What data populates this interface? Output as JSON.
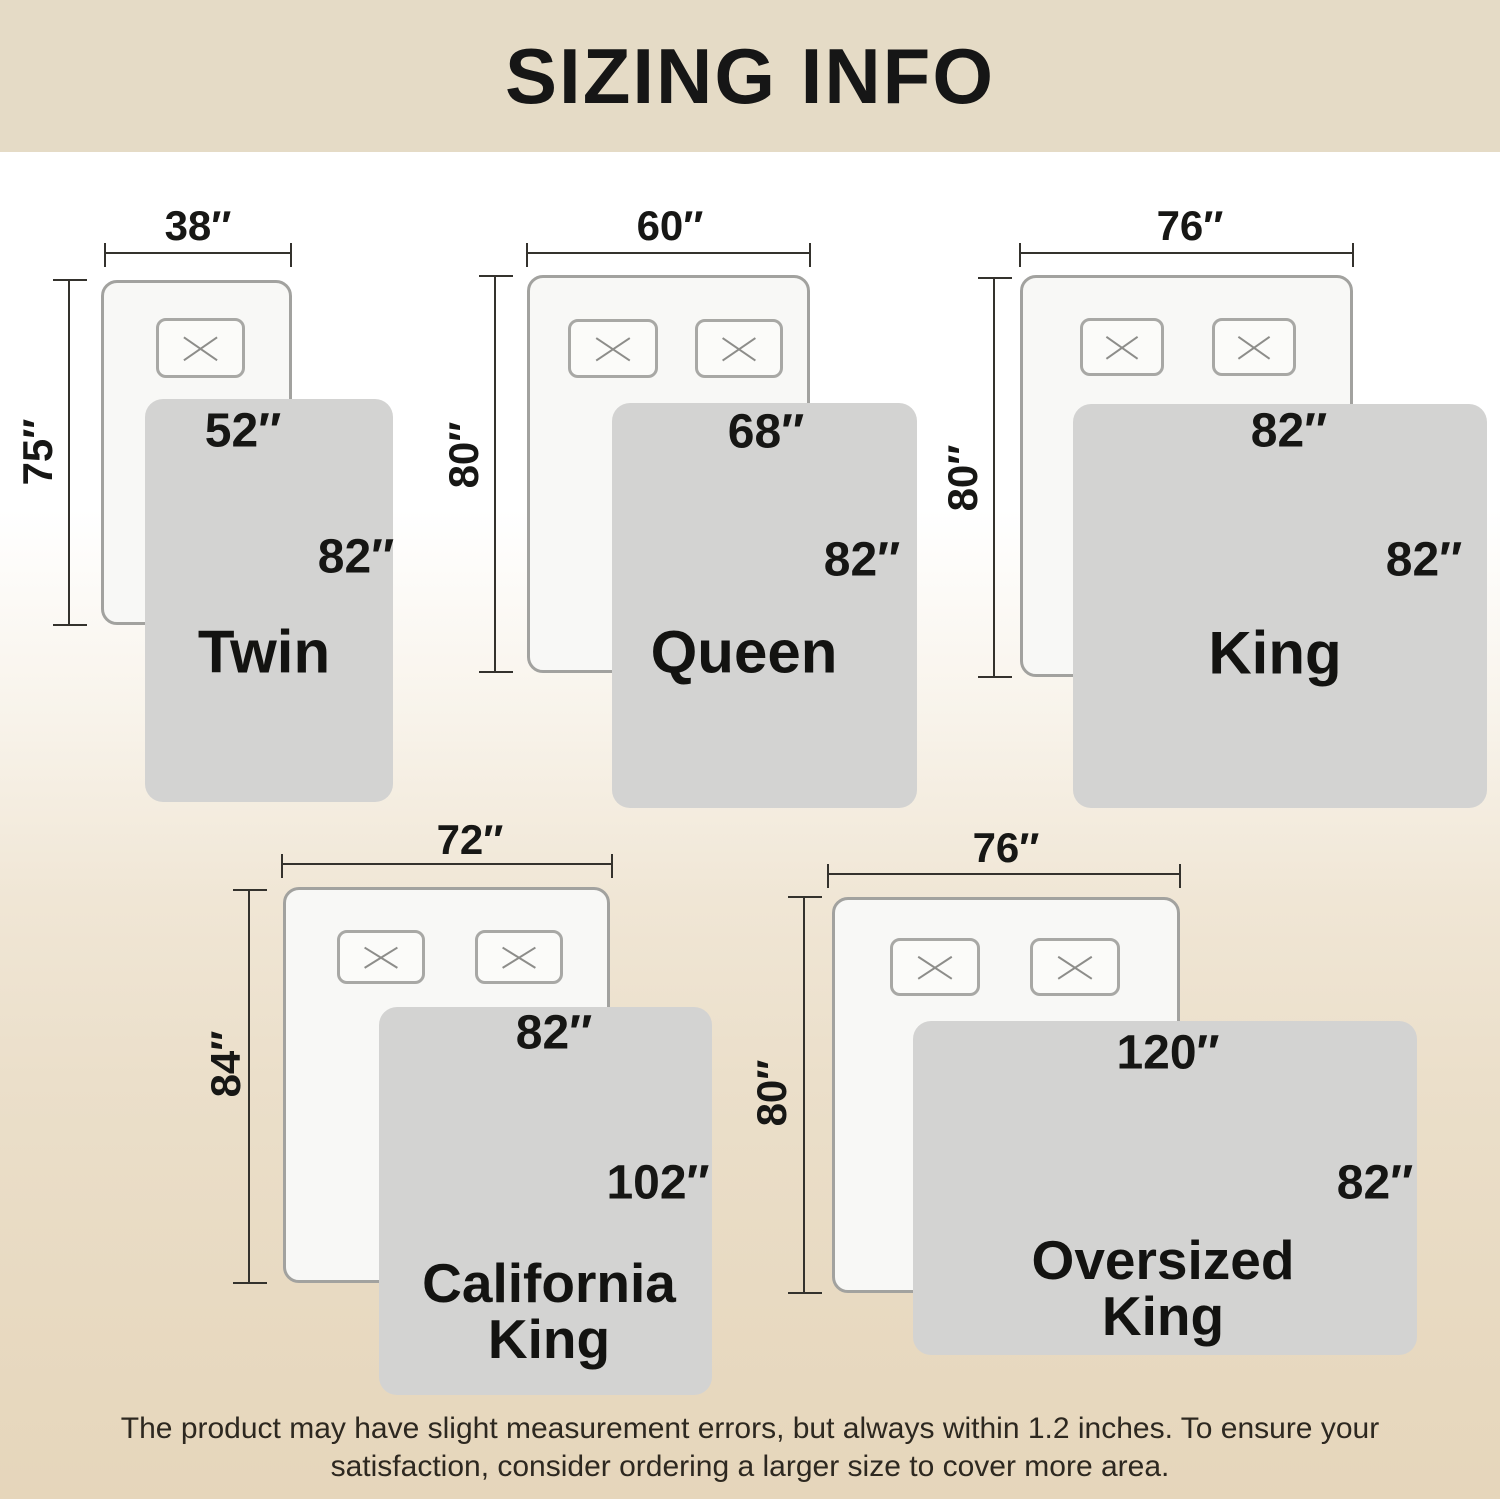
{
  "header": {
    "title": "SIZING INFO"
  },
  "footer": {
    "note": "The product may have slight measurement errors, but always within 1.2 inches. To ensure your satisfaction, consider ordering a larger size to cover more area."
  },
  "colors": {
    "header_bg": "#e5dbc6",
    "background_top": "#ffffff",
    "background_bottom": "#e6d6bb",
    "blanket_fill": "#d3d3d2",
    "bed_fill": "#f8f8f6",
    "bed_border": "#a2a29f",
    "dimension_line": "#34322d",
    "label_text": "#161614"
  },
  "sizes": [
    {
      "id": "twin",
      "name_lines": [
        "Twin"
      ],
      "bed_width_in": 38,
      "bed_length_in": 75,
      "blanket_width_in": 52,
      "blanket_length_in": 82,
      "bed_width_label": "38″",
      "bed_length_label": "75″",
      "blanket_width_label": "52″",
      "blanket_length_label": "82″",
      "geometry": {
        "hdim": {
          "x": 105,
          "y": 252,
          "w": 186
        },
        "hdim_label": {
          "x": 198,
          "y": 226
        },
        "vdim": {
          "x": 68,
          "y": 280,
          "h": 345
        },
        "vdim_label": {
          "x": 38,
          "y": 452
        },
        "bed": {
          "x": 101,
          "y": 280,
          "w": 191,
          "h": 345
        },
        "pillows": [
          {
            "x": 156,
            "y": 318,
            "w": 89,
            "h": 60
          }
        ],
        "blanket": {
          "x": 145,
          "y": 399,
          "w": 248,
          "h": 403
        },
        "blanket_w_label": {
          "x": 243,
          "y": 431
        },
        "blanket_l_label": {
          "x": 356,
          "y": 557
        },
        "name_pos": {
          "x": 264,
          "y": 652
        }
      }
    },
    {
      "id": "queen",
      "name_lines": [
        "Queen"
      ],
      "bed_width_in": 60,
      "bed_length_in": 80,
      "blanket_width_in": 68,
      "blanket_length_in": 82,
      "bed_width_label": "60″",
      "bed_length_label": "80″",
      "blanket_width_label": "68″",
      "blanket_length_label": "82″",
      "geometry": {
        "hdim": {
          "x": 527,
          "y": 252,
          "w": 283
        },
        "hdim_label": {
          "x": 670,
          "y": 226
        },
        "vdim": {
          "x": 494,
          "y": 276,
          "h": 396
        },
        "vdim_label": {
          "x": 464,
          "y": 455
        },
        "bed": {
          "x": 527,
          "y": 275,
          "w": 283,
          "h": 398
        },
        "pillows": [
          {
            "x": 568,
            "y": 319,
            "w": 90,
            "h": 59
          },
          {
            "x": 695,
            "y": 319,
            "w": 88,
            "h": 59
          }
        ],
        "blanket": {
          "x": 612,
          "y": 403,
          "w": 305,
          "h": 405
        },
        "blanket_w_label": {
          "x": 766,
          "y": 432
        },
        "blanket_l_label": {
          "x": 862,
          "y": 560
        },
        "name_pos": {
          "x": 744,
          "y": 652
        }
      }
    },
    {
      "id": "king",
      "name_lines": [
        "King"
      ],
      "bed_width_in": 76,
      "bed_length_in": 80,
      "blanket_width_in": 82,
      "blanket_length_in": 82,
      "bed_width_label": "76″",
      "bed_length_label": "80″",
      "blanket_width_label": "82″",
      "blanket_length_label": "82″",
      "geometry": {
        "hdim": {
          "x": 1020,
          "y": 252,
          "w": 333
        },
        "hdim_label": {
          "x": 1190,
          "y": 226
        },
        "vdim": {
          "x": 993,
          "y": 278,
          "h": 399
        },
        "vdim_label": {
          "x": 963,
          "y": 478
        },
        "bed": {
          "x": 1020,
          "y": 275,
          "w": 333,
          "h": 402
        },
        "pillows": [
          {
            "x": 1080,
            "y": 318,
            "w": 84,
            "h": 58
          },
          {
            "x": 1212,
            "y": 318,
            "w": 84,
            "h": 58
          }
        ],
        "blanket": {
          "x": 1073,
          "y": 404,
          "w": 414,
          "h": 404
        },
        "blanket_w_label": {
          "x": 1289,
          "y": 431
        },
        "blanket_l_label": {
          "x": 1424,
          "y": 560
        },
        "name_pos": {
          "x": 1275,
          "y": 653
        }
      }
    },
    {
      "id": "california-king",
      "name_lines": [
        "California",
        "King"
      ],
      "bed_width_in": 72,
      "bed_length_in": 84,
      "blanket_width_in": 82,
      "blanket_length_in": 102,
      "bed_width_label": "72″",
      "bed_length_label": "84″",
      "blanket_width_label": "82″",
      "blanket_length_label": "102″",
      "geometry": {
        "hdim": {
          "x": 282,
          "y": 863,
          "w": 330
        },
        "hdim_label": {
          "x": 470,
          "y": 840
        },
        "vdim": {
          "x": 248,
          "y": 890,
          "h": 393
        },
        "vdim_label": {
          "x": 226,
          "y": 1064
        },
        "bed": {
          "x": 283,
          "y": 887,
          "w": 327,
          "h": 396
        },
        "pillows": [
          {
            "x": 337,
            "y": 930,
            "w": 88,
            "h": 54
          },
          {
            "x": 475,
            "y": 930,
            "w": 88,
            "h": 54
          }
        ],
        "blanket": {
          "x": 379,
          "y": 1007,
          "w": 333,
          "h": 388
        },
        "blanket_w_label": {
          "x": 554,
          "y": 1033
        },
        "blanket_l_label": {
          "x": 658,
          "y": 1183
        },
        "name_pos": {
          "x": 549,
          "y": 1311
        }
      }
    },
    {
      "id": "oversized-king",
      "name_lines": [
        "Oversized",
        "King"
      ],
      "bed_width_in": 76,
      "bed_length_in": 80,
      "blanket_width_in": 120,
      "blanket_length_in": 82,
      "bed_width_label": "76″",
      "bed_length_label": "80″",
      "blanket_width_label": "120″",
      "blanket_length_label": "82″",
      "geometry": {
        "hdim": {
          "x": 828,
          "y": 873,
          "w": 352
        },
        "hdim_label": {
          "x": 1006,
          "y": 848
        },
        "vdim": {
          "x": 803,
          "y": 897,
          "h": 396
        },
        "vdim_label": {
          "x": 772,
          "y": 1093
        },
        "bed": {
          "x": 832,
          "y": 897,
          "w": 348,
          "h": 396
        },
        "pillows": [
          {
            "x": 890,
            "y": 938,
            "w": 90,
            "h": 58
          },
          {
            "x": 1030,
            "y": 938,
            "w": 90,
            "h": 58
          }
        ],
        "blanket": {
          "x": 913,
          "y": 1021,
          "w": 504,
          "h": 334
        },
        "blanket_w_label": {
          "x": 1168,
          "y": 1053
        },
        "blanket_l_label": {
          "x": 1375,
          "y": 1183
        },
        "name_pos": {
          "x": 1163,
          "y": 1288
        }
      }
    }
  ]
}
